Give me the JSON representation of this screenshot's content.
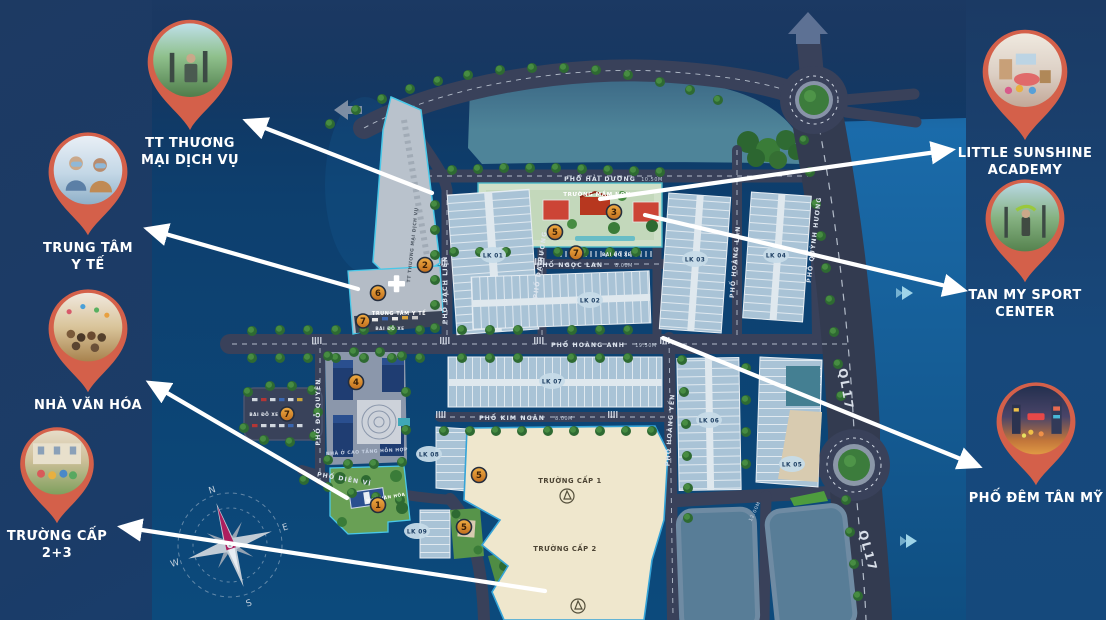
{
  "page": {
    "bg_navy": "#1c3a64",
    "pin_color": "#d4604a",
    "arrow_color": "#ffffff",
    "label_color": "#ffffff"
  },
  "callouts": {
    "left": [
      {
        "id": "tt-thuong-mai-dich-vu",
        "lines": [
          "TT THƯƠNG",
          "MẠI DỊCH VỤ"
        ]
      },
      {
        "id": "trung-tam-y-te",
        "lines": [
          "TRUNG TÂM",
          "Y TẾ"
        ]
      },
      {
        "id": "nha-van-hoa",
        "lines": [
          "NHÀ VĂN HÓA"
        ]
      },
      {
        "id": "truong-cap-2-3",
        "lines": [
          "TRƯỜNG CẤP",
          "2+3"
        ]
      }
    ],
    "right": [
      {
        "id": "little-sunshine-academy",
        "lines": [
          "LITTLE SUNSHINE",
          "ACADEMY"
        ]
      },
      {
        "id": "tan-my-sport-center",
        "lines": [
          "TAN MY SPORT",
          "CENTER"
        ]
      },
      {
        "id": "pho-dem-tan-my",
        "lines": [
          "PHỐ ĐÊM TÂN MỸ"
        ]
      }
    ]
  },
  "map": {
    "streets": {
      "hai_duong": "PHỐ HẢI DƯƠNG",
      "ngoc_lan": "PHỐ NGỌC LAN",
      "hoang_anh": "PHỐ HOÀNG ANH",
      "kim_ngan": "PHỐ KIM NGÂN",
      "bach_lien": "PHỐ BẠCH LIÊN",
      "da_huong": "PHỐ DẠ HƯƠNG",
      "hoang_lan": "PHỐ HOÀNG LAN",
      "quynh_huong": "PHỐ QUỲNH HƯƠNG",
      "hoang_yen": "PHỐ HOÀNG YẾN",
      "do_quyen": "PHỐ ĐỖ QUYÊN",
      "dien_vi": "PHỐ DIÊN VĨ",
      "ql17": "QL17"
    },
    "widths": {
      "hai_duong": "10.50M",
      "ngoc_lan": "8.00M",
      "hoang_anh": "19.50M",
      "kim_ngan": "8.00M",
      "vertical": "12.00M"
    },
    "blocks": {
      "lk01": "LK 01",
      "lk02": "LK 02",
      "lk03": "LK 03",
      "lk04": "LK 04",
      "lk05": "LK 05",
      "lk06": "LK 06",
      "lk07": "LK 07",
      "lk08": "LK 08",
      "lk09": "LK 09"
    },
    "areas": {
      "mam_non": "TRƯỜNG MẦM NON",
      "y_te": "TRUNG TÂM Y TẾ",
      "bai_do_xe": "BÃI ĐỖ XE",
      "cap1": "TRƯỜNG CẤP 1",
      "cap2": "TRƯỜNG CẤP 2",
      "van_hoa": "NHÀ VĂN HÓA",
      "cao_tang": "NHÀ Ở CAO TẦNG HỖN HỢP",
      "tt_tm": "TT THƯƠNG MẠI DỊCH VỤ"
    },
    "markers": {
      "m1": "1",
      "m2": "2",
      "m3": "3",
      "m4": "4",
      "m5": "5",
      "m6": "6",
      "m7": "7"
    },
    "compass": {
      "n": "N",
      "e": "E",
      "s": "S",
      "w": "W"
    }
  }
}
